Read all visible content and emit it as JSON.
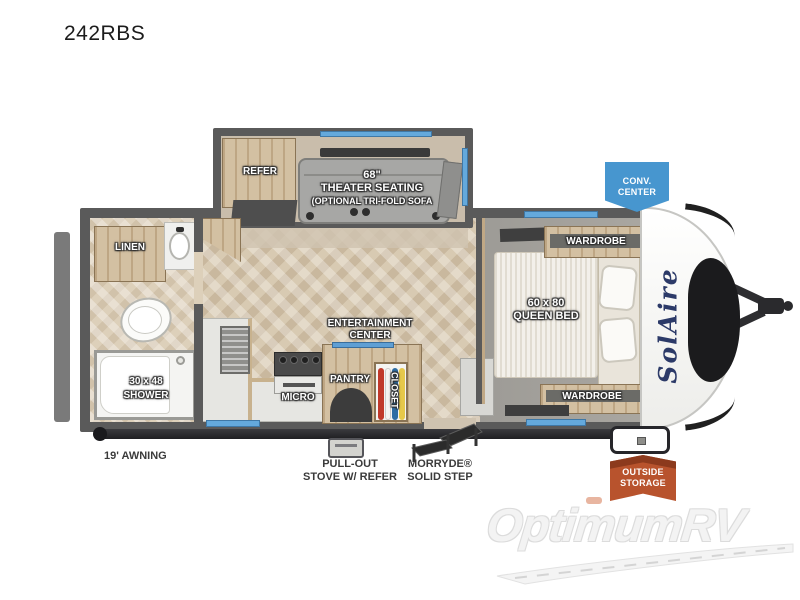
{
  "page": {
    "model": "242RBS",
    "watermark": "OptimumRV"
  },
  "slideout": {
    "refer_label": "REFER",
    "theater_size": "68\"",
    "theater_label": "THEATER SEATING",
    "theater_option": "(OPTIONAL TRI-FOLD SOFA"
  },
  "bathroom": {
    "linen_label": "LINEN",
    "shower_size": "30 x 48",
    "shower_label": "SHOWER"
  },
  "kitchen": {
    "entertainment_line1": "ENTERTAINMENT",
    "entertainment_line2": "CENTER",
    "pantry_label": "PANTRY",
    "micro_label": "MICRO",
    "closet_label": "CLOSET"
  },
  "bedroom": {
    "wardrobe_top_label": "WARDROBE",
    "bed_size": "60 x 80",
    "bed_label": "QUEEN BED",
    "wardrobe_bottom_label": "WARDROBE"
  },
  "exterior": {
    "awning_label": "19' AWNING",
    "stove_line1": "PULL-OUT",
    "stove_line2": "STOVE W/ REFER",
    "step_line1": "MORRYDE®",
    "step_line2": "SOLID STEP",
    "conv_line1": "CONV.",
    "conv_line2": "CENTER",
    "storage_line1": "OUTSIDE",
    "storage_line2": "STORAGE",
    "brand_logo": "SolAire"
  },
  "colors": {
    "badge_blue": "#4796cf",
    "badge_orange": "#b8532d",
    "window_blue": "#64a9dc",
    "wall_gray": "#5a5a5a",
    "wood": "#cdb795",
    "floor": "#d8cab2"
  }
}
